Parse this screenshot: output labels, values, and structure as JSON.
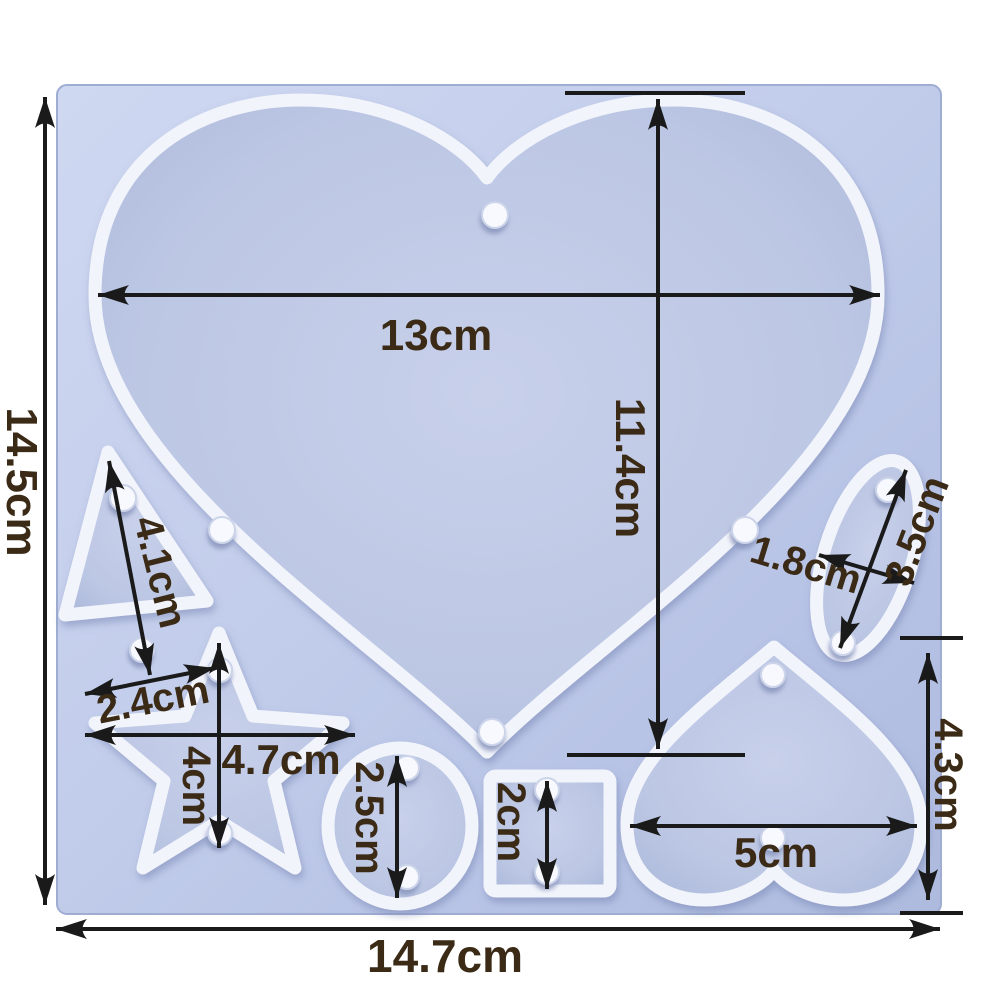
{
  "diagram_title": "silicone-mold-dimension-diagram",
  "colors": {
    "background": "#ffffff",
    "mold_surface": "#bcc8e8",
    "cavity_floor": "#b2bedd",
    "rim": "#f2f4fb",
    "peg": "#f7f9fe",
    "dimension_line": "#1a1a1a",
    "dimension_text": "#3a2a16"
  },
  "mold": {
    "cavities": [
      "large-heart",
      "triangle",
      "star",
      "circle",
      "square",
      "small-heart",
      "oval"
    ],
    "peg_count": 16
  },
  "dimensions": {
    "overall_height": "14.5cm",
    "overall_width": "14.7cm",
    "heart_width": "13cm",
    "heart_height": "11.4cm",
    "triangle_side": "4.1cm",
    "triangle_base": "2.4cm",
    "star_width": "4.7cm",
    "star_height": "4cm",
    "circle_diameter": "2.5cm",
    "square_size": "2cm",
    "small_heart_width": "5cm",
    "small_heart_height": "4.3cm",
    "oval_width": "1.8cm",
    "oval_length": "3.5cm"
  }
}
